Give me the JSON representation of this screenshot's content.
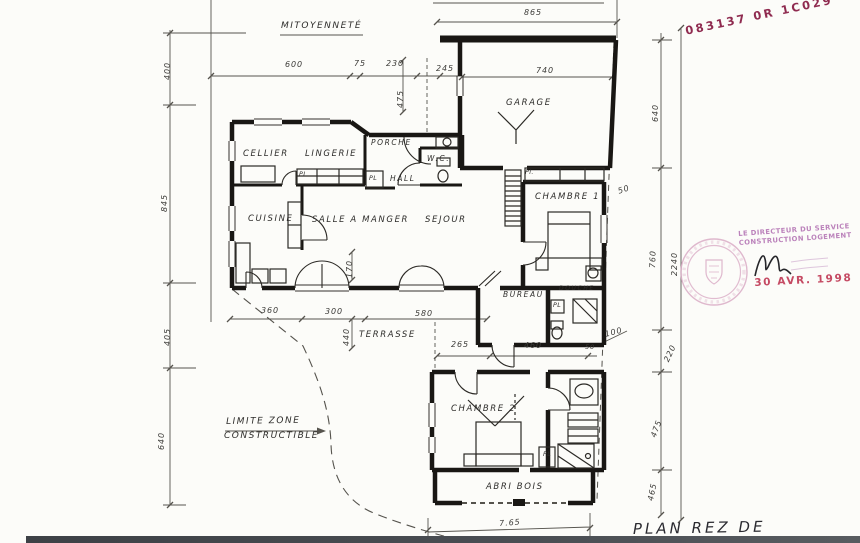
{
  "document": {
    "type": "architectural floor plan scan",
    "floor": "rez-de-chaussée"
  },
  "plan_title": "PLAN REZ DE CHAUSSÉE",
  "colors": {
    "paper": "#fcfcf9",
    "ink": "#191714",
    "dim_ink": "#56544e",
    "reference_stamp": "#8f2b50",
    "director_stamp": "#b678b6",
    "date_stamp": "#c54a63",
    "seal_pink": "#d9abc6",
    "bottom_bar": "#44484c"
  },
  "stamps": {
    "reference": "083137 0R 1C029",
    "director_line1": "LE DIRECTEUR DU SERVICE",
    "director_line2": "CONSTRUCTION LOGEMENT",
    "date": "30 AVR. 1998"
  },
  "annotations": [
    {
      "id": "mitoyennete",
      "text": "MITOYENNETÉ",
      "x": 281,
      "y": 22
    },
    {
      "id": "limite-zone-line1",
      "text": "LIMITE ZONE",
      "x": 226,
      "y": 418,
      "rot": -1
    },
    {
      "id": "limite-zone-line2",
      "text": "CONSTRUCTIBLE",
      "x": 224,
      "y": 432
    }
  ],
  "rooms": [
    {
      "id": "cellier",
      "text": "CELLIER",
      "x": 243,
      "y": 150
    },
    {
      "id": "lingerie",
      "text": "LINGERIE",
      "x": 305,
      "y": 150
    },
    {
      "id": "porche",
      "text": "PORCHE",
      "x": 371,
      "y": 139,
      "size": 7.5
    },
    {
      "id": "wc",
      "text": "W.C.",
      "x": 427,
      "y": 155,
      "size": 7.5
    },
    {
      "id": "hall",
      "text": "HALL",
      "x": 390,
      "y": 175,
      "size": 7.5
    },
    {
      "id": "cuisine",
      "text": "CUISINE",
      "x": 248,
      "y": 215
    },
    {
      "id": "salle-a-manger",
      "text": "SALLE A MANGER",
      "x": 312,
      "y": 216
    },
    {
      "id": "sejour",
      "text": "SEJOUR",
      "x": 425,
      "y": 216
    },
    {
      "id": "garage",
      "text": "GARAGE",
      "x": 506,
      "y": 99
    },
    {
      "id": "chambre-1",
      "text": "CHAMBRE 1",
      "x": 535,
      "y": 193
    },
    {
      "id": "bureau",
      "text": "BUREAU",
      "x": 503,
      "y": 291,
      "size": 7.5
    },
    {
      "id": "douche",
      "text": "DOUCHE",
      "x": 559,
      "y": 286,
      "size": 6
    },
    {
      "id": "chambre-2",
      "text": "CHAMBRE 2",
      "x": 451,
      "y": 405
    },
    {
      "id": "terrasse",
      "text": "TERRASSE",
      "x": 359,
      "y": 331
    },
    {
      "id": "abri-bois",
      "text": "ABRI BOIS",
      "x": 486,
      "y": 483
    }
  ],
  "closets": [
    {
      "id": "lingerie-pl",
      "text": "PL",
      "x": 299,
      "y": 172
    },
    {
      "id": "hall-pl",
      "text": "PL",
      "x": 369,
      "y": 176
    },
    {
      "id": "chambre1-pl",
      "text": "Pl.",
      "x": 525,
      "y": 170
    },
    {
      "id": "douche-pl",
      "text": "PL",
      "x": 553,
      "y": 303
    },
    {
      "id": "chambre2-pl",
      "text": "PL",
      "x": 543,
      "y": 452
    }
  ],
  "dims": [
    {
      "id": "865",
      "text": "865",
      "x": 524,
      "y": 9
    },
    {
      "id": "740",
      "text": "740",
      "x": 536,
      "y": 67
    },
    {
      "id": "600",
      "text": "600",
      "x": 285,
      "y": 61
    },
    {
      "id": "75",
      "text": "75",
      "x": 354,
      "y": 60
    },
    {
      "id": "230",
      "text": "230",
      "x": 386,
      "y": 60
    },
    {
      "id": "245",
      "text": "245",
      "x": 436,
      "y": 65
    },
    {
      "id": "475-top",
      "text": "475",
      "x": 397,
      "y": 108,
      "rot": -90
    },
    {
      "id": "400-left",
      "text": "400",
      "x": 164,
      "y": 80,
      "rot": -90
    },
    {
      "id": "845-left",
      "text": "845",
      "x": 161,
      "y": 212,
      "rot": -90
    },
    {
      "id": "405-left",
      "text": "405",
      "x": 164,
      "y": 346,
      "rot": -90
    },
    {
      "id": "640-left",
      "text": "640",
      "x": 158,
      "y": 450,
      "rot": -90
    },
    {
      "id": "640-right",
      "text": "640",
      "x": 652,
      "y": 122,
      "rot": -90
    },
    {
      "id": "760-right",
      "text": "760",
      "x": 649,
      "y": 268,
      "rot": -88
    },
    {
      "id": "2240-right",
      "text": "2240",
      "x": 671,
      "y": 276,
      "rot": -90
    },
    {
      "id": "220-right",
      "text": "220",
      "x": 663,
      "y": 360,
      "rot": -65
    },
    {
      "id": "475-right",
      "text": "475",
      "x": 650,
      "y": 436,
      "rot": -70
    },
    {
      "id": "465-right",
      "text": "465",
      "x": 647,
      "y": 500,
      "rot": -78
    },
    {
      "id": "50-chambre1",
      "text": "50",
      "x": 617,
      "y": 188,
      "rot": -18
    },
    {
      "id": "100-right",
      "text": "100",
      "x": 604,
      "y": 331,
      "rot": -14
    },
    {
      "id": "360",
      "text": "360",
      "x": 261,
      "y": 307
    },
    {
      "id": "300",
      "text": "300",
      "x": 325,
      "y": 308
    },
    {
      "id": "580",
      "text": "580",
      "x": 415,
      "y": 310
    },
    {
      "id": "440",
      "text": "440",
      "x": 343,
      "y": 346,
      "rot": -90
    },
    {
      "id": "170",
      "text": "170",
      "x": 346,
      "y": 278,
      "rot": -90
    },
    {
      "id": "265",
      "text": "265",
      "x": 451,
      "y": 341
    },
    {
      "id": "460",
      "text": "460",
      "x": 524,
      "y": 342
    },
    {
      "id": "50-terrasse",
      "text": "50",
      "x": 585,
      "y": 344,
      "size": 6.5
    },
    {
      "id": "765",
      "text": "7.65",
      "x": 499,
      "y": 520,
      "rot": -4
    }
  ]
}
